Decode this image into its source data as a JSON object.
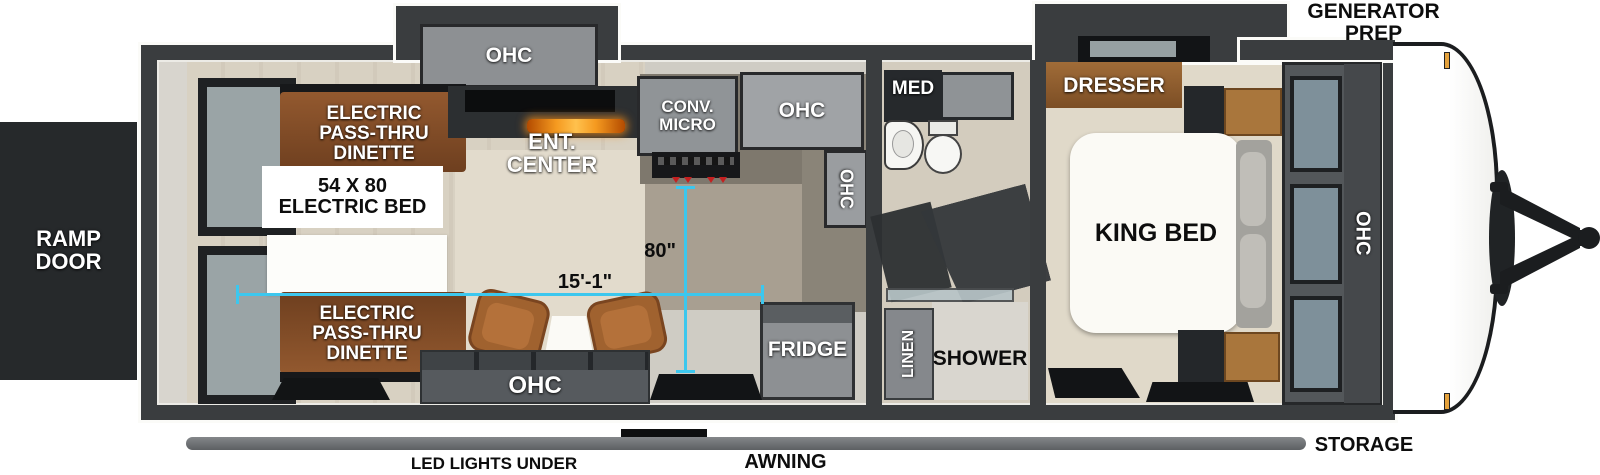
{
  "title": "Travel trailer floorplan",
  "colors": {
    "wall": "#3a3d3f",
    "floor": "#d8d1c2",
    "wood": "#8a5a33",
    "dinette_brown": "#7d4e2e",
    "cabinet_gray": "#8f9296",
    "dimension_cyan": "#3cc7ee",
    "fireplace_orange": "#f08c1a"
  },
  "exterior": {
    "ramp_door": "RAMP\nDOOR",
    "generator_prep": "GENERATOR\nPREP",
    "storage": "STORAGE",
    "awning": "AWNING",
    "led_lights": "LED LIGHTS UNDER AWNING"
  },
  "labels": {
    "ohc": "OHC"
  },
  "garage": {
    "dinette_front": "ELECTRIC\nPASS-THRU\nDINETTE",
    "dinette_rear": "ELECTRIC\nPASS-THRU\nDINETTE",
    "electric_bed": "54 X 80\nELECTRIC BED",
    "ent_center": "ENT.\nCENTER"
  },
  "kitchen": {
    "conv_micro": "CONV.\nMICRO",
    "fridge": "FRIDGE"
  },
  "bath": {
    "med": "MED",
    "shower": "SHOWER",
    "linen": "LINEN"
  },
  "bedroom": {
    "dresser": "DRESSER",
    "king_bed": "KING BED"
  },
  "dimensions": {
    "interior_width": "15'-1\"",
    "garage_depth": "80\""
  }
}
